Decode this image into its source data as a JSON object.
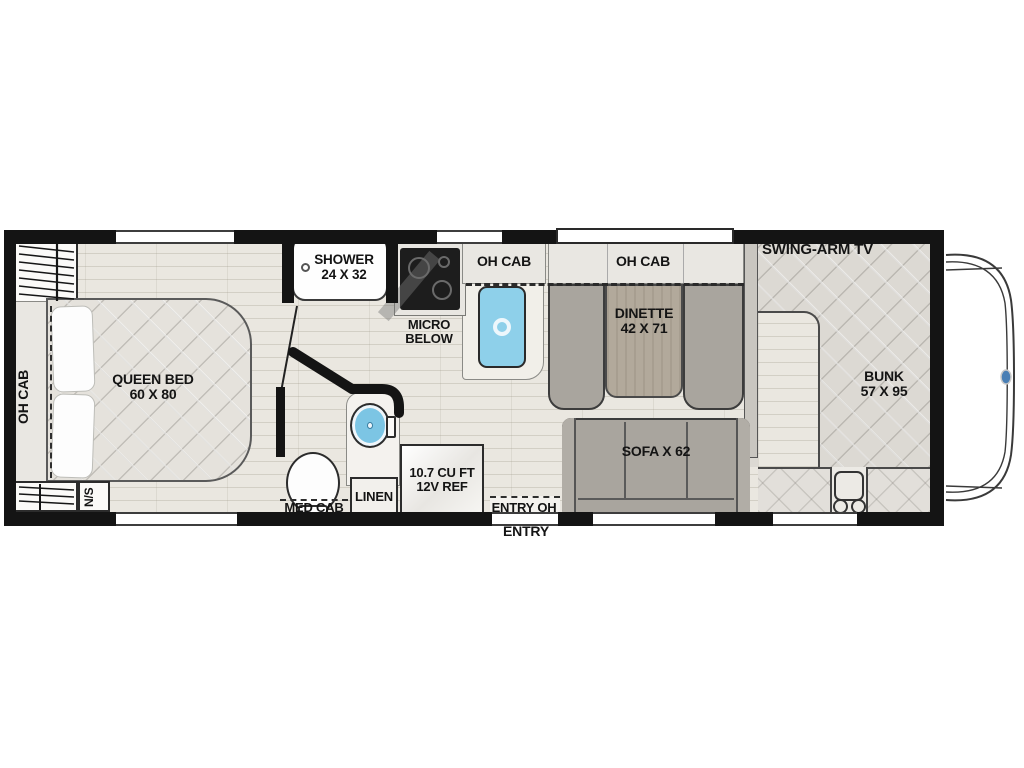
{
  "plan": {
    "type": "rv-class-c-floorplan",
    "labels": {
      "oh_cab_rear": "OH CAB",
      "queen_bed": {
        "line1": "QUEEN BED",
        "line2": "60 X 80"
      },
      "nightstand": "N/S",
      "shower": {
        "line1": "SHOWER",
        "line2": "24 X 32"
      },
      "micro": {
        "line1": "MICRO",
        "line2": "BELOW"
      },
      "oh_cab_kitchen": "OH CAB",
      "oh_cab_dinette": "OH CAB",
      "dinette": {
        "line1": "DINETTE",
        "line2": "42 X 71"
      },
      "swing_arm_tv": "SWING-ARM TV",
      "bunk": {
        "line1": "BUNK",
        "line2": "57 X 95"
      },
      "sofa": "SOFA X 62",
      "fridge": {
        "line1": "10.7 CU FT",
        "line2": "12V REF"
      },
      "linen": "LINEN",
      "med_cab": "MED CAB",
      "entry_oh": "ENTRY OH",
      "entry": "ENTRY"
    },
    "colors": {
      "wall": "#141414",
      "floor": "#eae7e0",
      "mattress_quilt": "#dcd9d3",
      "cushion_gray": "#a9a59e",
      "table_wood": "#b2a99b",
      "sink_blue": "#8ed0ea",
      "counter_white": "#f4f2ee",
      "logo_blue": "#4a7fb5"
    }
  }
}
